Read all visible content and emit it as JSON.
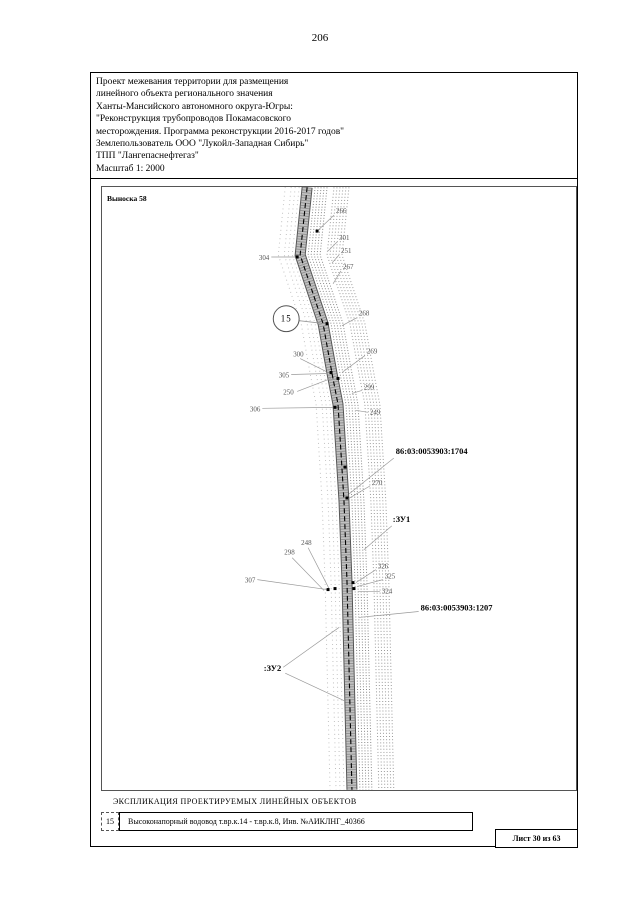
{
  "page_number": "206",
  "header": {
    "lines": [
      "Проект межевания территории для размещения",
      "линейного объекта регионального значения",
      "Ханты-Мансийского автономного округа-Югры:",
      "\"Реконструкция трубопроводов Покамасовского",
      "месторождения. Программа реконструкции 2016-2017 годов\"",
      "Землепользователь ООО \"Лукойл-Западная Сибирь\"",
      "ТПП \"Лангепаснефтегаз\"",
      "Масштаб 1: 2000"
    ]
  },
  "colors": {
    "frame": "#000000",
    "map_line_gray": "#8a8a8a",
    "band_fill": "#c2c2c2",
    "band_edge": "#555555",
    "label_gray": "#555555",
    "leader_gray": "#999999"
  },
  "map": {
    "callout": "Выноска 58",
    "circle": {
      "label": "15",
      "cx": 185,
      "cy": 132,
      "r": 13,
      "leader": [
        [
          198,
          134
        ],
        [
          224,
          137
        ]
      ]
    },
    "corridor": {
      "centerline": [
        [
          206,
          0
        ],
        [
          199,
          68
        ],
        [
          222,
          137
        ],
        [
          231,
          187
        ],
        [
          237,
          218
        ],
        [
          243,
          315
        ],
        [
          246,
          395
        ],
        [
          251,
          605
        ]
      ],
      "right_inner_offsets": [
        8,
        11,
        14,
        17,
        20
      ],
      "right_outer_offsets": [
        27,
        30,
        33,
        36,
        39,
        42
      ],
      "left_offsets": [
        -8,
        -12,
        -16,
        -22
      ]
    },
    "markers": [
      [
        216,
        44
      ],
      [
        196,
        70
      ],
      [
        226,
        137
      ],
      [
        230,
        186
      ],
      [
        237,
        192
      ],
      [
        234,
        221
      ],
      [
        244,
        281
      ],
      [
        246,
        312
      ],
      [
        227,
        404
      ],
      [
        234,
        403
      ],
      [
        252,
        397
      ],
      [
        253,
        403
      ]
    ],
    "labels": [
      {
        "text": "266",
        "x": 235,
        "y": 26,
        "leaders": [
          [
            [
              233,
              28
            ],
            [
              216,
              44
            ]
          ]
        ]
      },
      {
        "text": "301",
        "x": 238,
        "y": 53,
        "leaders": [
          [
            [
              236,
              55
            ],
            [
              227,
              64
            ]
          ]
        ]
      },
      {
        "text": "251",
        "x": 240,
        "y": 66,
        "leaders": [
          [
            [
              238,
              68
            ],
            [
              231,
              76
            ]
          ]
        ]
      },
      {
        "text": "267",
        "x": 242,
        "y": 82,
        "leaders": [
          [
            [
              240,
              84
            ],
            [
              232,
              97
            ]
          ]
        ]
      },
      {
        "text": "304",
        "x": 168,
        "y": 73,
        "anchor": "end",
        "leaders": [
          [
            [
              170,
              70
            ],
            [
              195,
              70
            ]
          ]
        ]
      },
      {
        "text": "268",
        "x": 258,
        "y": 129,
        "leaders": [
          [
            [
              256,
              131
            ],
            [
              241,
              139
            ]
          ]
        ]
      },
      {
        "text": "300",
        "x": 192,
        "y": 170,
        "leaders": [
          [
            [
              199,
              172
            ],
            [
              225,
              185
            ]
          ]
        ]
      },
      {
        "text": "269",
        "x": 266,
        "y": 167,
        "leaders": [
          [
            [
              264,
              169
            ],
            [
              241,
              186
            ]
          ]
        ]
      },
      {
        "text": "305",
        "x": 188,
        "y": 191,
        "anchor": "end",
        "leaders": [
          [
            [
              190,
              188
            ],
            [
              227,
              187
            ]
          ]
        ]
      },
      {
        "text": "250",
        "x": 182,
        "y": 208,
        "leaders": [
          [
            [
              196,
              205
            ],
            [
              230,
              192
            ]
          ]
        ]
      },
      {
        "text": "299",
        "x": 263,
        "y": 203,
        "leaders": [
          [
            [
              261,
              204
            ],
            [
              251,
              207
            ]
          ]
        ]
      },
      {
        "text": "306",
        "x": 159,
        "y": 225,
        "anchor": "end",
        "leaders": [
          [
            [
              161,
              222
            ],
            [
              232,
              221
            ]
          ]
        ]
      },
      {
        "text": "249",
        "x": 269,
        "y": 228,
        "leaders": [
          [
            [
              267,
              226
            ],
            [
              255,
              224
            ]
          ]
        ]
      },
      {
        "text": "86:03:0053903:1704",
        "x": 295,
        "y": 268,
        "bold": true,
        "leaders": [
          [
            [
              293,
              272
            ],
            [
              248,
              308
            ]
          ]
        ]
      },
      {
        "text": "270",
        "x": 271,
        "y": 299,
        "leaders": [
          [
            [
              269,
              300
            ],
            [
              247,
              313
            ]
          ]
        ]
      },
      {
        "text": ":ЗУ1",
        "x": 292,
        "y": 336,
        "bold": true,
        "leaders": [
          [
            [
              291,
              340
            ],
            [
              263,
              364
            ]
          ]
        ]
      },
      {
        "text": "248",
        "x": 200,
        "y": 359,
        "leaders": [
          [
            [
              207,
              362
            ],
            [
              228,
              403
            ]
          ]
        ]
      },
      {
        "text": "298",
        "x": 183,
        "y": 369,
        "leaders": [
          [
            [
              191,
              372
            ],
            [
              223,
              405
            ]
          ]
        ]
      },
      {
        "text": "326",
        "x": 277,
        "y": 383,
        "leaders": [
          [
            [
              275,
              384
            ],
            [
              255,
              397
            ]
          ]
        ]
      },
      {
        "text": "325",
        "x": 284,
        "y": 393,
        "leaders": [
          [
            [
              282,
              394
            ],
            [
              256,
              401
            ]
          ]
        ]
      },
      {
        "text": "307",
        "x": 154,
        "y": 397,
        "anchor": "end",
        "leaders": [
          [
            [
              156,
              394
            ],
            [
              226,
              404
            ]
          ]
        ]
      },
      {
        "text": "324",
        "x": 281,
        "y": 408,
        "leaders": [
          [
            [
              279,
              406
            ],
            [
              257,
              406
            ]
          ]
        ]
      },
      {
        "text": "86:03:0053903:1207",
        "x": 320,
        "y": 425,
        "bold": true,
        "leaders": [
          [
            [
              318,
              426
            ],
            [
              258,
              432
            ]
          ]
        ]
      },
      {
        "text": ":ЗУ2",
        "x": 180,
        "y": 486,
        "anchor": "end",
        "bold": true,
        "leaders": [
          [
            [
              182,
              482
            ],
            [
              238,
              442
            ]
          ],
          [
            [
              184,
              488
            ],
            [
              244,
              516
            ]
          ]
        ]
      }
    ]
  },
  "legend": {
    "title": "ЭКСПЛИКАЦИЯ ПРОЕКТИРУЕМЫХ ЛИНЕЙНЫХ ОБЪЕКТОВ",
    "rows": [
      {
        "num": "15",
        "text": "Высоконапорный водовод т.вр.к.14 - т.вр.к.8, Инв. №АИКЛНГ_40366"
      }
    ]
  },
  "footer": {
    "sheet_label": "Лист 30 из 63"
  }
}
